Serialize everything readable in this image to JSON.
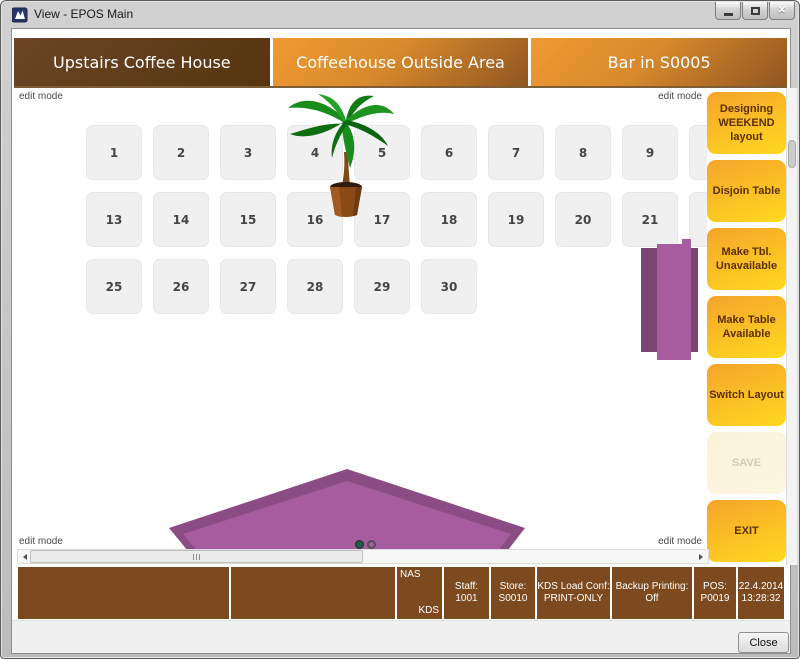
{
  "window": {
    "title": "View - EPOS Main"
  },
  "icons": {
    "close_glyph": "✕",
    "app_icon": "epos-app-icon"
  },
  "edit_mode_label": "edit mode",
  "tabs": [
    {
      "label": "Upstairs Coffee House",
      "selected": true
    },
    {
      "label": "Coffeehouse Outside Area",
      "selected": false
    },
    {
      "label": "Bar in S0005",
      "selected": false
    }
  ],
  "floor": {
    "rows": [
      {
        "tables": [
          "1",
          "2",
          "3",
          "4",
          "5",
          "6",
          "7",
          "8",
          "9",
          ""
        ]
      },
      {
        "tables": [
          "13",
          "14",
          "15",
          "16",
          "17",
          "18",
          "19",
          "20",
          "21",
          ""
        ]
      },
      {
        "tables": [
          "25",
          "26",
          "27",
          "28",
          "29",
          "30"
        ]
      }
    ],
    "objects": [
      "potted-palm-plant",
      "purple-rect-table",
      "purple-pentagon-table"
    ],
    "pager": {
      "count": 2,
      "active": 0
    }
  },
  "sidebar": {
    "buttons": [
      {
        "label": "Designing WEEKEND layout",
        "disabled": false
      },
      {
        "label": "Disjoin Table",
        "disabled": false
      },
      {
        "label": "Make Tbl. Unavailable",
        "disabled": false
      },
      {
        "label": "Make Table Available",
        "disabled": false
      },
      {
        "label": "Switch Layout",
        "disabled": false
      },
      {
        "label": "SAVE",
        "disabled": true
      },
      {
        "label": "EXIT",
        "disabled": false
      }
    ]
  },
  "status_bar": {
    "cells": [
      {
        "type": "blank"
      },
      {
        "type": "blank"
      },
      {
        "type": "corner",
        "tl": "NAS",
        "br": "KDS"
      },
      {
        "type": "kv",
        "label": "Staff:",
        "value": "1001"
      },
      {
        "type": "kv",
        "label": "Store:",
        "value": "S0010"
      },
      {
        "type": "kv",
        "label": "KDS Load Conf:",
        "value": "PRINT-ONLY"
      },
      {
        "type": "kv",
        "label": "Backup Printing:",
        "value": "Off"
      },
      {
        "type": "kv",
        "label": "POS:",
        "value": "P0019"
      },
      {
        "type": "kv",
        "label": "22.4.2014",
        "value": "13:28:32"
      }
    ]
  },
  "footer": {
    "close_label": "Close"
  },
  "colors": {
    "tab_selected": "#56350f",
    "tab_unselected_start": "#f09a33",
    "tab_unselected_end": "#8f5520",
    "button_yellow_start": "#f5a42b",
    "button_yellow_end": "#ffd91f",
    "button_text": "#5c2e04",
    "status_brown": "#7c4a1e",
    "shape_purple": "#a65c9f",
    "shape_purple_dark": "#7a4573"
  }
}
